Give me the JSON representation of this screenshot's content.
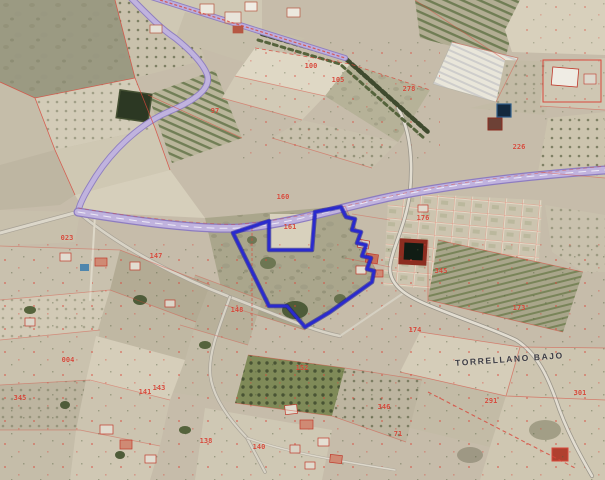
{
  "map": {
    "type": "aerial-orthophoto-with-cadastral-overlay",
    "place_label": "TORRELLANO BAJO",
    "selected_parcel": {
      "outline_color": "#2a2ace"
    },
    "overlay_colors": {
      "cadastral_lines": "#d9473b",
      "parcel_numbers": "#d63c2e",
      "main_road": "#c0b3de",
      "selection_outline": "#2a2ace"
    },
    "parcel_labels": [
      {
        "text": "100",
        "x": 311,
        "y": 66
      },
      {
        "text": "105",
        "x": 338,
        "y": 80
      },
      {
        "text": "278",
        "x": 409,
        "y": 89
      },
      {
        "text": "97",
        "x": 215,
        "y": 111
      },
      {
        "text": "226",
        "x": 519,
        "y": 147
      },
      {
        "text": "176",
        "x": 423,
        "y": 218
      },
      {
        "text": "160",
        "x": 283,
        "y": 197
      },
      {
        "text": "161",
        "x": 290,
        "y": 227
      },
      {
        "text": "147",
        "x": 156,
        "y": 256
      },
      {
        "text": "023",
        "x": 67,
        "y": 238
      },
      {
        "text": "345",
        "x": 441,
        "y": 271
      },
      {
        "text": "148",
        "x": 237,
        "y": 310
      },
      {
        "text": "173",
        "x": 519,
        "y": 308
      },
      {
        "text": "174",
        "x": 415,
        "y": 330
      },
      {
        "text": "152",
        "x": 302,
        "y": 368
      },
      {
        "text": "143",
        "x": 159,
        "y": 388
      },
      {
        "text": "141",
        "x": 145,
        "y": 392
      },
      {
        "text": "004",
        "x": 68,
        "y": 360
      },
      {
        "text": "346",
        "x": 384,
        "y": 407
      },
      {
        "text": "71",
        "x": 398,
        "y": 434
      },
      {
        "text": "345",
        "x": 20,
        "y": 398
      },
      {
        "text": "291",
        "x": 491,
        "y": 401
      },
      {
        "text": "301",
        "x": 580,
        "y": 393
      },
      {
        "text": "140",
        "x": 259,
        "y": 447
      },
      {
        "text": "138",
        "x": 206,
        "y": 441
      }
    ]
  }
}
